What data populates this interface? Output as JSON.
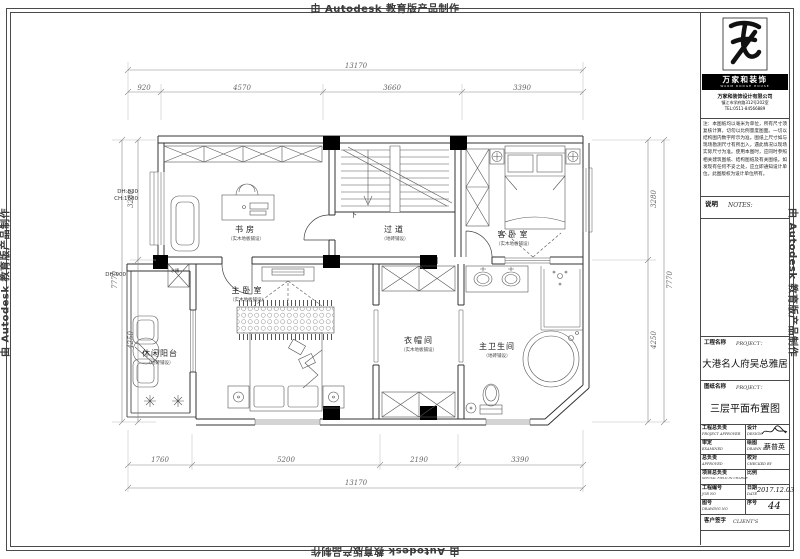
{
  "watermark": {
    "text": "由 Autodesk 教育版产品制作"
  },
  "plan": {
    "rooms": {
      "study": {
        "name": "书房",
        "sub": "（实木地板铺设）"
      },
      "corridor": {
        "name": "过道",
        "sub": "（地砖铺设）"
      },
      "guest": {
        "name": "客卧室",
        "sub": "（实木地板铺设）"
      },
      "master": {
        "name": "主卧室",
        "sub": "（实木地板铺设）"
      },
      "balcony": {
        "name": "休闲阳台",
        "sub": "（地砖铺设）"
      },
      "cloakroom": {
        "name": "衣帽间",
        "sub": "（实木地板铺设）"
      },
      "bathroom": {
        "name": "主卫生间",
        "sub": "（地砖铺设）"
      }
    },
    "annotations": {
      "stairs_down": "下",
      "sink": "水槽",
      "dh_window": "DH:830",
      "ch_window": "CH:1680",
      "dh_balcony": "DH:900"
    },
    "dims": {
      "top_overall": "13170",
      "top": [
        "920",
        "4570",
        "3660",
        "3390"
      ],
      "bottom": [
        "1760",
        "5200",
        "2190",
        "3390"
      ],
      "bottom_overall": "13170",
      "left": [
        "3280",
        "4250"
      ],
      "left_overall": "7770",
      "right": [
        "3280",
        "4250"
      ],
      "right_overall": "7770"
    }
  },
  "titleblock": {
    "brand": {
      "banner": "万家和装饰",
      "tagline": "WARM DODGE HOUSE",
      "company": "万家和装饰设计有限公司",
      "address": "镇江市学府路312号202室",
      "phone": "TEL:0511-84566889"
    },
    "notes_text": "注：本图纸均以毫米为单位，所有尺寸须复核计算，切勿以比例量度图面。一切以结构图内数字所示为准。图纸上尺寸如与现场勘测尺寸有所出入，遇此情况以现场实际尺寸为准。使用本图时，应同时参照相关建筑图纸、结构图纸及有关图纸。如发现有任何不妥之处，应立即通知设计单位。此图版权为设计单位所有。",
    "notes_label_cn": "说明",
    "notes_label_en": "NOTES:",
    "project_label_cn": "工程名称",
    "project_label_en": "PROJECT：",
    "project_name": "大港名人府吴总雅居",
    "drawing_label_cn": "图纸名称",
    "drawing_label_en": "PROJECT：",
    "drawing_name": "三层平面布置图",
    "fields": {
      "pa_cn": "工程总负责",
      "pa_en": "PROJECT APPROVER",
      "design_cn": "设计",
      "design_en": "DESIGN",
      "examined_cn": "审定",
      "examined_en": "EXAMINED",
      "drawn_cn": "绘图",
      "drawn_en": "DRAWN BY",
      "drawn_value": "蔡普英",
      "approved_cn": "总负责",
      "approved_en": "APPROVED",
      "checked_cn": "校对",
      "checked_en": "CHECKED BY",
      "special_cn": "项目总负责",
      "special_en": "SPECIAL FIELD IN CHARGE",
      "scale_cn": "比例",
      "job_cn": "工程编号",
      "job_en": "JOB NO",
      "date_cn": "日期",
      "date_en": "DATE",
      "date_value": "2017.12.03",
      "dwg_cn": "图号",
      "dwg_en": "DRAWING NO",
      "serial_cn": "序号",
      "serial_value": "44",
      "client_cn": "客户签字",
      "client_en": "CLIENT'S"
    }
  }
}
